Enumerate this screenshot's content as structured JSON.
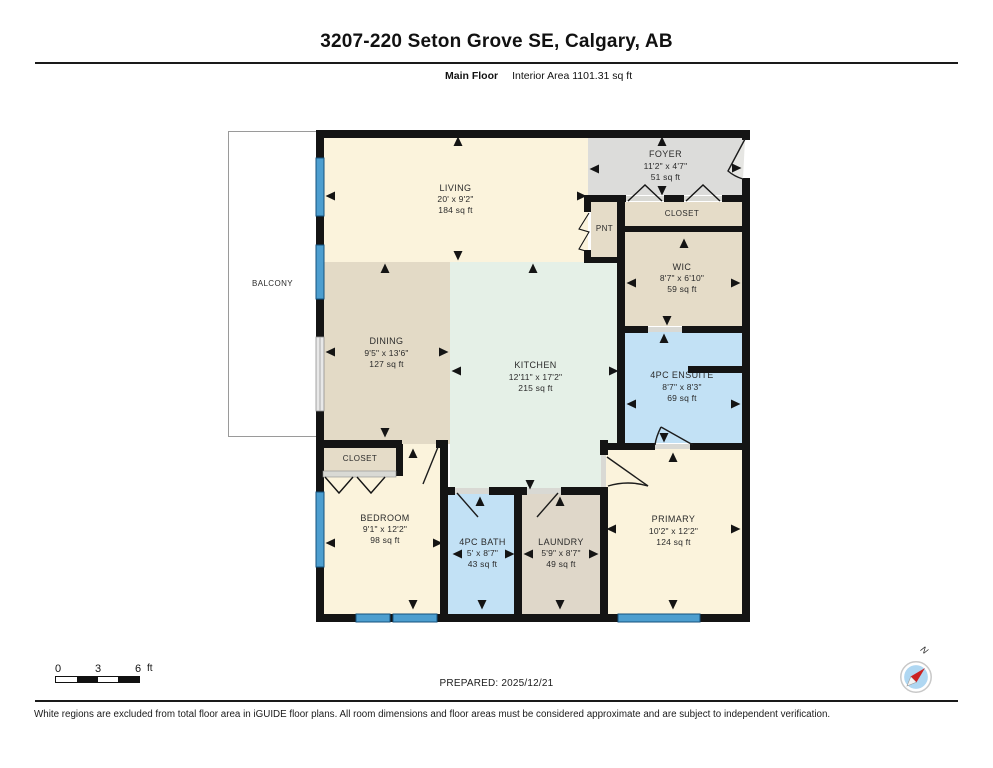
{
  "header": {
    "title": "3207-220 Seton Grove SE, Calgary, AB",
    "floor_label": "Main Floor",
    "interior_area": "Interior Area 1101.31 sq ft"
  },
  "rooms": {
    "balcony": {
      "name": "BALCONY"
    },
    "living": {
      "name": "LIVING",
      "dims": "20' x 9'2\"",
      "area": "184 sq ft"
    },
    "foyer": {
      "name": "FOYER",
      "dims": "11'2\" x 4'7\"",
      "area": "51 sq ft"
    },
    "closet_top": {
      "name": "CLOSET"
    },
    "pnt": {
      "name": "PNT"
    },
    "wic": {
      "name": "WIC",
      "dims": "8'7\" x 6'10\"",
      "area": "59 sq ft"
    },
    "dining": {
      "name": "DINING",
      "dims": "9'5\" x 13'6\"",
      "area": "127 sq ft"
    },
    "kitchen": {
      "name": "KITCHEN",
      "dims": "12'11\" x 17'2\"",
      "area": "215 sq ft"
    },
    "ensuite": {
      "name": "4PC ENSUITE",
      "dims": "8'7\" x 8'3\"",
      "area": "69 sq ft"
    },
    "closet_bottom": {
      "name": "CLOSET"
    },
    "bedroom": {
      "name": "BEDROOM",
      "dims": "9'1\" x 12'2\"",
      "area": "98 sq ft"
    },
    "bath": {
      "name": "4PC BATH",
      "dims": "5' x 8'7\"",
      "area": "43 sq ft"
    },
    "laundry": {
      "name": "LAUNDRY",
      "dims": "5'9\" x 8'7\"",
      "area": "49 sq ft"
    },
    "primary": {
      "name": "PRIMARY",
      "dims": "10'2\" x 12'2\"",
      "area": "124 sq ft"
    }
  },
  "scale_bar": {
    "label_0": "0",
    "label_3": "3",
    "label_6": "6",
    "unit": "ft"
  },
  "compass": {
    "north_label": "N"
  },
  "footer": {
    "prepared": "PREPARED: 2025/12/21",
    "disclaimer": "White regions are excluded from total floor area in iGUIDE floor plans. All room dimensions and floor areas must be considered approximate and are subject to independent verification."
  },
  "palette": {
    "cream": "#FBF3DC",
    "tan": "#E5DCC8",
    "dining_tan": "#E3DAC6",
    "laundry_tan": "#DFD7C9",
    "mint": "#E5F0E7",
    "blue": "#C2E1F5",
    "foyer_gray": "#DCDCDA",
    "wall": "#141414",
    "window": "#4D9ECF",
    "window_edge": "#14527E",
    "sill": "#D9D9D4"
  }
}
